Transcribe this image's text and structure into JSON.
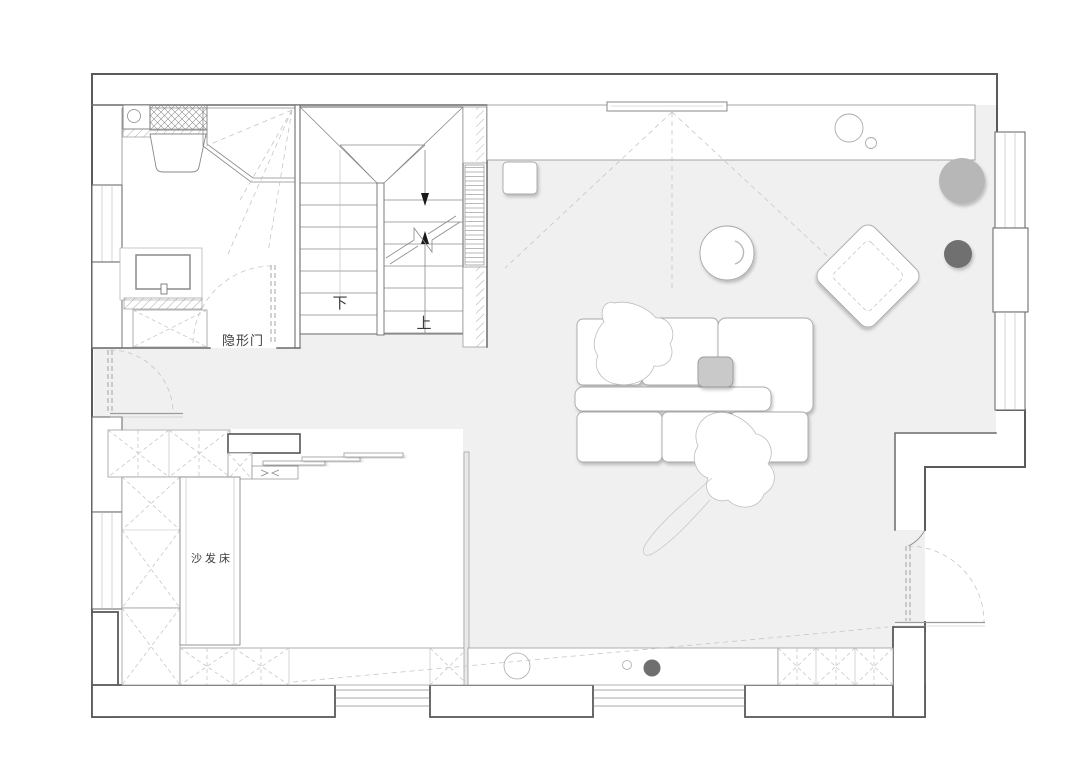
{
  "plan": {
    "labels": {
      "hidden_door": "隐形门",
      "stairs_down": "下",
      "stairs_up": "上",
      "sofa_bed": "沙发床"
    },
    "colors": {
      "floor": "#f0f0f1",
      "wall": "#5a5a5a",
      "furniture_line": "#a8a8a8",
      "dashed_line": "#c6c6c6",
      "pouf_light": "#b7b7b7",
      "pouf_dark": "#6f6f6f",
      "tray": "#c9c9c9"
    }
  }
}
